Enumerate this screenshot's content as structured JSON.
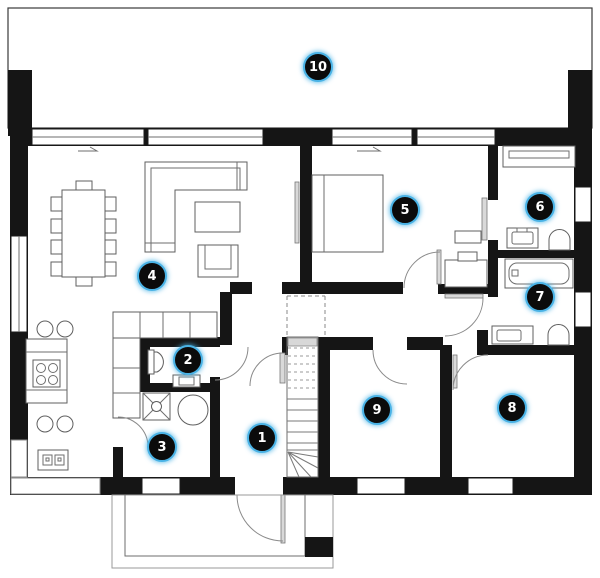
{
  "colors": {
    "background": "#ffffff",
    "wall": "#151515",
    "furniture_line": "#5f5f5f",
    "badge_fill": "#0b0b0b",
    "badge_ring": "#4ab3e6",
    "badge_number": "#ffffff"
  },
  "badges": [
    {
      "label": "1"
    },
    {
      "label": "2"
    },
    {
      "label": "3"
    },
    {
      "label": "4"
    },
    {
      "label": "5"
    },
    {
      "label": "6"
    },
    {
      "label": "7"
    },
    {
      "label": "8"
    },
    {
      "label": "9"
    },
    {
      "label": "10"
    }
  ]
}
